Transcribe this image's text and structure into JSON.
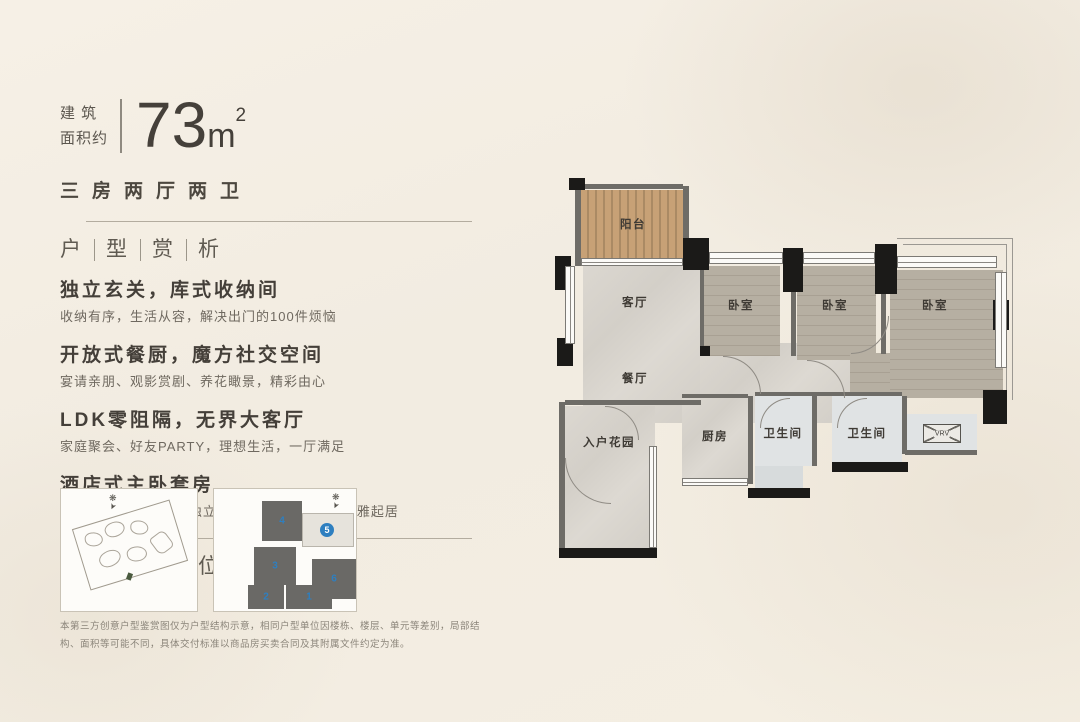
{
  "header": {
    "category_line1": "建 筑",
    "category_line2": "面积约",
    "area_value": "73",
    "area_unit": "m",
    "area_sup": "2",
    "layout_type": "三房两厅两卫"
  },
  "analysis": {
    "title_chars": [
      "户",
      "型",
      "赏",
      "析"
    ],
    "features": [
      {
        "title": "独立玄关，库式收纳间",
        "desc": "收纳有序，生活从容，解决出门的100件烦恼"
      },
      {
        "title": "开放式餐厨，魔方社交空间",
        "desc": "宴请亲朋、观影赏剧、养花瞰景，精彩由心"
      },
      {
        "title": "LDK零阻隔，无界大客厅",
        "desc": "家庭聚会、好友PARTY，理想生活，一厅满足"
      },
      {
        "title": "酒店式主卧套房",
        "desc": "270°通透采光，配备独立衣帽间，风景陪伴，优雅起居"
      }
    ]
  },
  "location": {
    "title_chars": [
      "户",
      "型",
      "落",
      "位"
    ]
  },
  "plan": {
    "rooms": [
      {
        "label": "阳台"
      },
      {
        "label": "客厅"
      },
      {
        "label": "餐厅"
      },
      {
        "label": "卧室"
      },
      {
        "label": "卧室"
      },
      {
        "label": "卧室"
      },
      {
        "label": "入户花园"
      },
      {
        "label": "厨房"
      },
      {
        "label": "卫生间"
      },
      {
        "label": "卫生间"
      },
      {
        "label": "VRV"
      }
    ]
  },
  "keyplan": {
    "units": [
      {
        "num": "1"
      },
      {
        "num": "2"
      },
      {
        "num": "3"
      },
      {
        "num": "4"
      },
      {
        "num": "5"
      },
      {
        "num": "6"
      }
    ],
    "highlighted_unit": "5"
  },
  "colors": {
    "accent_blue": "#2e7fc0",
    "wall_black": "#1b1a18",
    "background_cream": "#f3ede2"
  },
  "disclaimer": "本第三方创意户型鉴赏图仅为户型结构示意，相同户型单位因楼栋、楼层、单元等差别，局部结构、面积等可能不同，具体交付标准以商品房买卖合同及其附属文件约定为准。"
}
